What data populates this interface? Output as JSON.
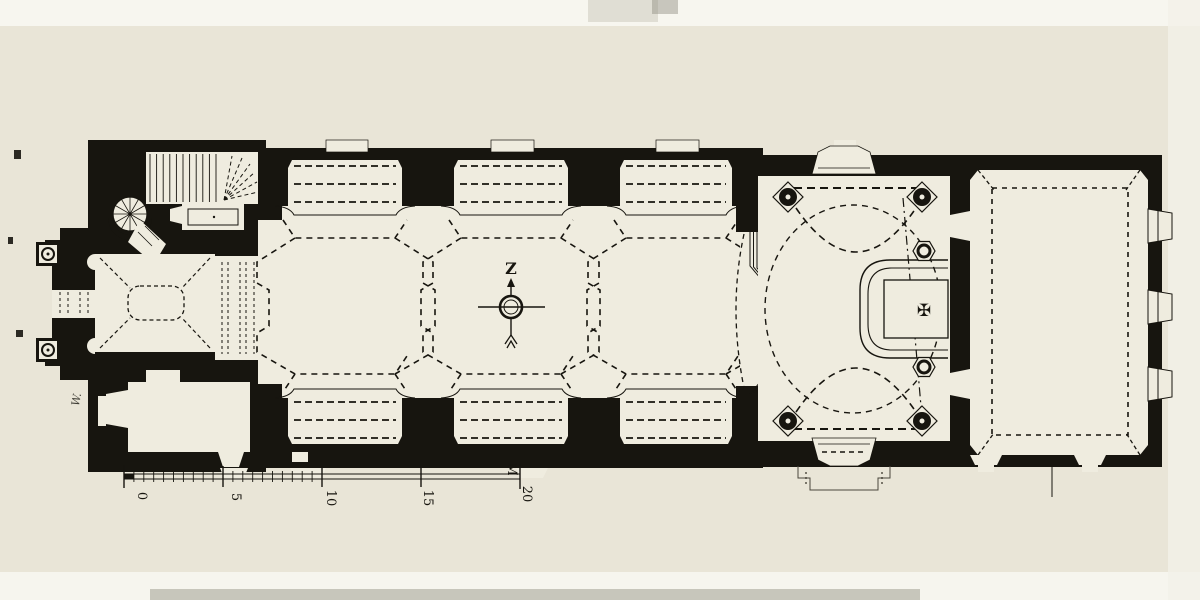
{
  "colors": {
    "paper": "#e9e5d7",
    "paper_light": "#f7f6ef",
    "floor": "#efecdf",
    "ink": "#17150f"
  },
  "compass": {
    "north_label": "Z"
  },
  "scale_bar": {
    "tick_labels": [
      "0",
      "5",
      "10",
      "15"
    ],
    "unit_label": "M",
    "end_label": "20"
  },
  "annotations": {
    "handwritten_mark": "W.",
    "altar_cross": "✠"
  }
}
